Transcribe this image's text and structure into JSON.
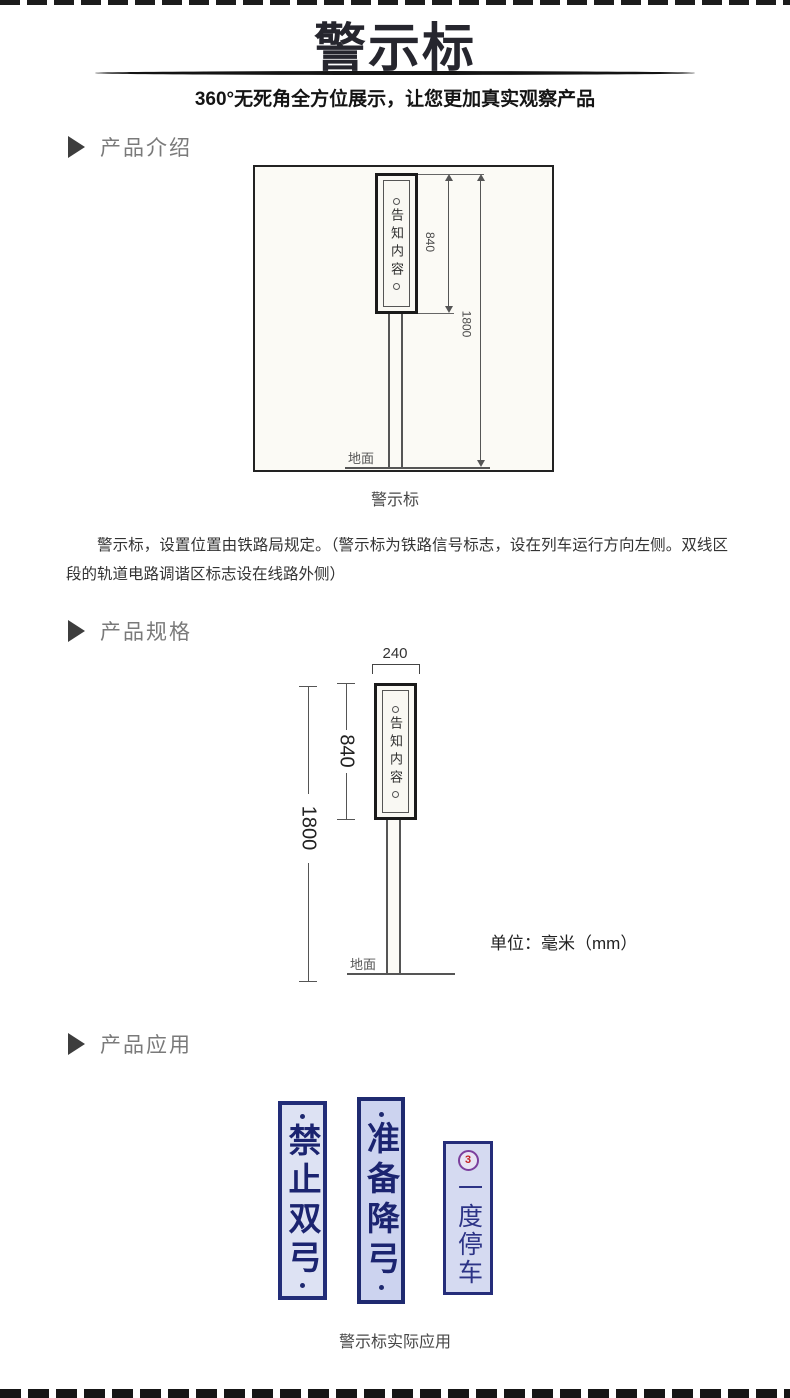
{
  "banner": {
    "title": "警示标",
    "subtitle": "360°无死角全方位展示，让您更加真实观察产品"
  },
  "sections": {
    "intro_label": "产品介绍",
    "spec_label": "产品规格",
    "app_label": "产品应用"
  },
  "diagram_intro": {
    "board_text": "告知内容",
    "dim_board_height": "840",
    "dim_total_height": "1800",
    "ground_label": "地面",
    "caption": "警示标"
  },
  "intro_paragraph": "警示标，设置位置由铁路局规定。（警示标为铁路信号标志，设在列车运行方向左侧。双线区段的轨道电路调谐区标志设在线路外侧）",
  "diagram_spec": {
    "board_text": "告知内容",
    "dim_width": "240",
    "dim_board_height": "840",
    "dim_total_height": "1800",
    "ground_label": "地面",
    "unit_note": "单位：毫米（mm）"
  },
  "application": {
    "signs": [
      {
        "text": "禁止双弓"
      },
      {
        "text": "准备降弓"
      },
      {
        "text": "一度停车",
        "badge": "3"
      }
    ],
    "caption": "警示标实际应用"
  },
  "colors": {
    "banner_text": "#26262e",
    "section_label": "#7a7a7a",
    "sketch_line": "#555555",
    "sign_navy": "#1f2a70",
    "sign_bg": "#d5daf1",
    "badge_red": "#c42222"
  }
}
